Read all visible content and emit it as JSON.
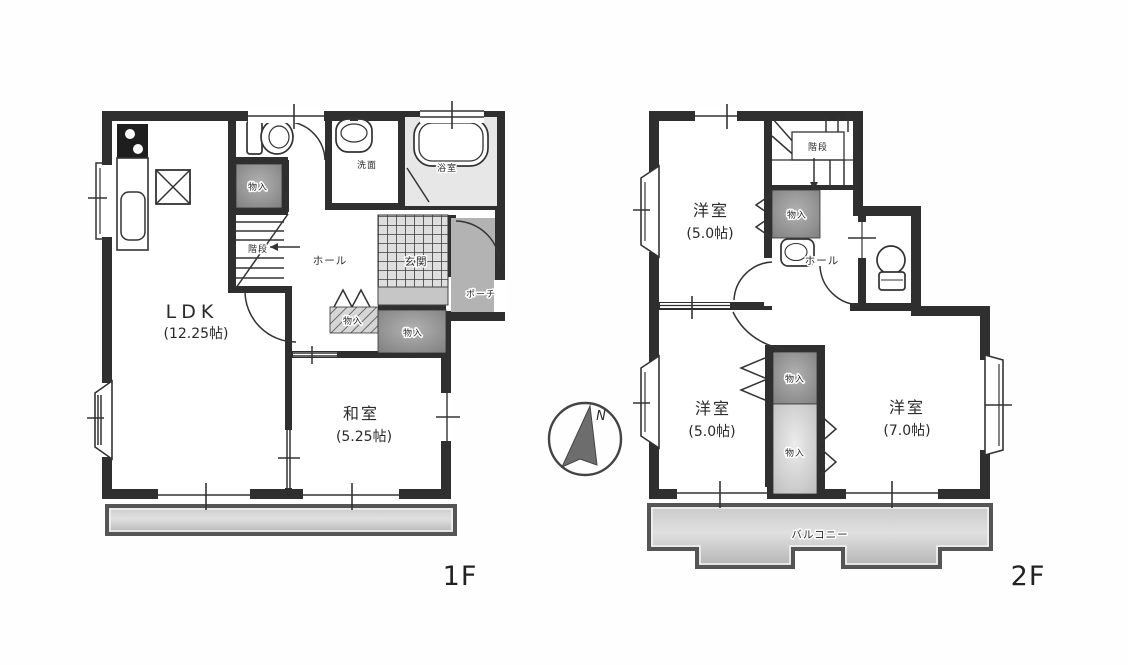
{
  "floor1": {
    "floor_label": "1F",
    "ldk_name": "LDK",
    "ldk_size": "(12.25帖)",
    "washitsu_name": "和室",
    "washitsu_size": "(5.25帖)",
    "hall": "ホール",
    "stairs": "階段",
    "genkan": "玄関",
    "porch": "ポーチ",
    "washroom": "洗面",
    "bathroom": "浴室",
    "closet1": "物入",
    "closet2": "物入",
    "closet3": "物入"
  },
  "floor2": {
    "floor_label": "2F",
    "room1_name": "洋室",
    "room1_size": "(5.0帖)",
    "room2_name": "洋室",
    "room2_size": "(5.0帖)",
    "room3_name": "洋室",
    "room3_size": "(7.0帖)",
    "stairs": "階段",
    "hall": "ホール",
    "balcony": "バルコニー",
    "closet1": "物入",
    "closet2": "物入",
    "closet3": "物入"
  },
  "compass": {
    "north_label": "N"
  },
  "colors": {
    "wall": "#2f2f2f",
    "closet_dark": "#8f8f8f",
    "closet_light": "#c6c6c6",
    "porch": "#b3b3b3",
    "deck": "#cfcfcf"
  }
}
